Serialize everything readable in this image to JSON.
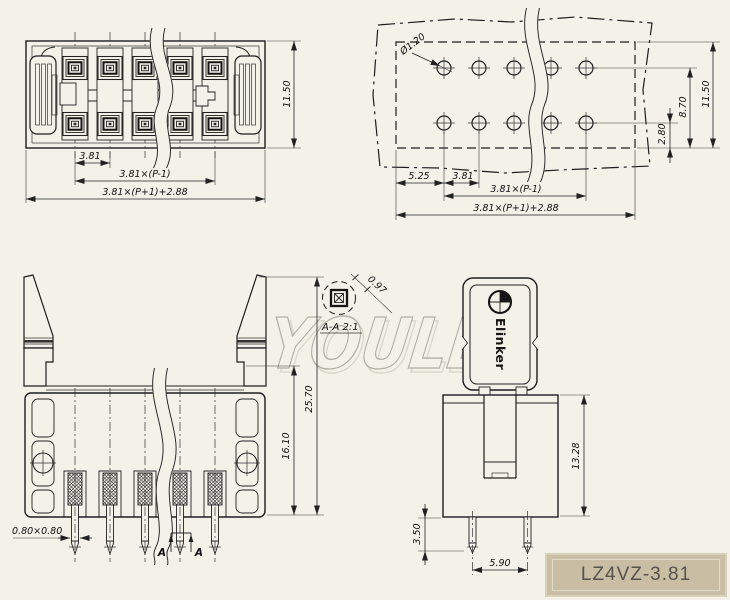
{
  "watermark": "YOULE",
  "part_number": "LZ4VZ-3.81",
  "brand_logo": "Elinker",
  "top_view": {
    "dim_height": "11.50",
    "dim_pitch": "3.81",
    "dim_span": "3.81×(P-1)",
    "dim_total": "3.81×(P+1)+2.88"
  },
  "pcb_view": {
    "dim_hole_dia": "Ø1.20",
    "dim_edge": "5.25",
    "dim_pitch": "3.81",
    "dim_span": "3.81×(P-1)",
    "dim_total": "3.81×(P+1)+2.88",
    "dim_row_offset": "2.80",
    "dim_row_edge": "8.70",
    "dim_height": "11.50"
  },
  "front_view": {
    "dim_pin_sq": "0.80×0.80",
    "dim_body_h": "16.10",
    "dim_total_h": "25.70",
    "section_left": "A",
    "section_right": "A"
  },
  "detail_view": {
    "label": "A-A 2:1",
    "dim_width": "0.97"
  },
  "side_view": {
    "dim_height": "13.28",
    "dim_pin_len": "3.50",
    "dim_pin_pitch": "5.90"
  }
}
